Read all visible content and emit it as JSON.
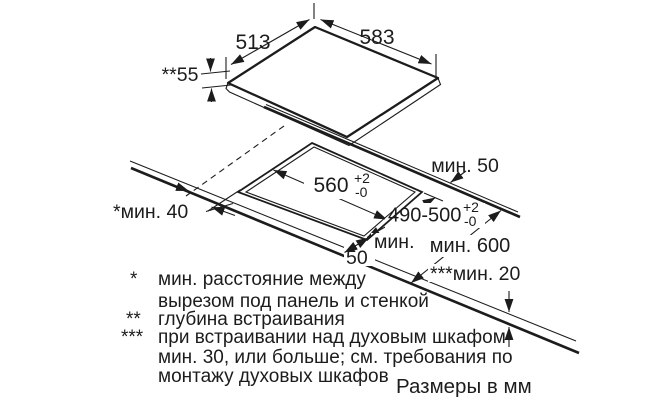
{
  "dims": {
    "panel_depth": "513",
    "panel_width": "583",
    "install_depth": "**55",
    "rear_clearance": "мин. 50",
    "cutout_width": {
      "value": "560",
      "tol_up": "+2",
      "tol_down": "-0"
    },
    "cutout_depth": {
      "value": "490-500",
      "tol_up": "+2",
      "tol_down": "-0"
    },
    "front_clearance": {
      "line1": "мин.",
      "line2": "50"
    },
    "side_clearance": "*мин. 40",
    "worktop_depth": "мин. 600",
    "bottom_clearance": "***мин. 20"
  },
  "footnotes": {
    "f1_marker": "*",
    "f1_line1": "мин. расстояние между",
    "f1_line2": "вырезом под панель и стенкой",
    "f2_marker": "**",
    "f2_text": "глубина встраивания",
    "f3_marker": "***",
    "f3_line1": "при встраивании над духовым шкафом",
    "f3_line2": "мин. 30, или больше; см. требования по",
    "f3_line3": "монтажу духовых шкафов",
    "units_note": "Размеры в мм"
  },
  "colors": {
    "ink": "#1c1c1c",
    "background": "#ffffff"
  }
}
